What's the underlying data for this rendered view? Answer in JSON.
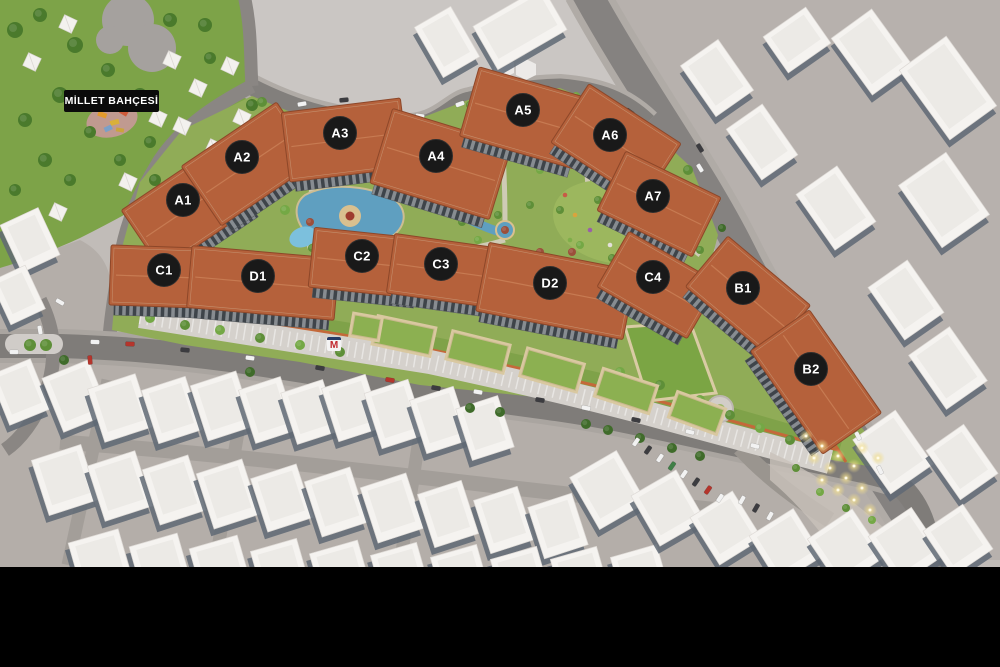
{
  "park": {
    "label": "MİLLET BAHÇESİ"
  },
  "metro": {
    "label": "M"
  },
  "colors": {
    "roof": "#b5613b",
    "roof_edge": "#8d4729",
    "badge": "#191919",
    "badge_text": "#ffffff",
    "grass": "#90ac57",
    "park_green": "#7da348",
    "pond": "#5f9fc0",
    "road": "#817e7b",
    "ground_light": "#cac6c3",
    "ground_pink": "#b7b1ad",
    "ground_bottom": "#b4aea9",
    "white_building": "#f5f3f0",
    "shadow_face": "#5f6874",
    "podium_edge": "#c4693a",
    "pavilion_roof": "#8cb051",
    "letterbox": "#000000"
  },
  "buildings": [
    {
      "label": "A1",
      "x": 183,
      "y": 200,
      "bx": 189,
      "by": 208,
      "w": 115,
      "h": 72,
      "rot": -34
    },
    {
      "label": "A2",
      "x": 242,
      "y": 157,
      "bx": 249,
      "by": 164,
      "w": 115,
      "h": 72,
      "rot": -34
    },
    {
      "label": "A3",
      "x": 340,
      "y": 133,
      "bx": 345,
      "by": 140,
      "w": 120,
      "h": 70,
      "rot": -7
    },
    {
      "label": "A4",
      "x": 436,
      "y": 156,
      "bx": 441,
      "by": 164,
      "w": 125,
      "h": 78,
      "rot": 17
    },
    {
      "label": "A5",
      "x": 523,
      "y": 110,
      "bx": 527,
      "by": 118,
      "w": 120,
      "h": 72,
      "rot": 16
    },
    {
      "label": "A6",
      "x": 610,
      "y": 135,
      "bx": 616,
      "by": 143,
      "w": 110,
      "h": 70,
      "rot": 33
    },
    {
      "label": "A7",
      "x": 653,
      "y": 196,
      "bx": 659,
      "by": 204,
      "w": 106,
      "h": 66,
      "rot": 26
    },
    {
      "label": "C1",
      "x": 164,
      "y": 270,
      "bx": 169,
      "by": 277,
      "w": 118,
      "h": 60,
      "rot": 2
    },
    {
      "label": "D1",
      "x": 258,
      "y": 276,
      "bx": 263,
      "by": 283,
      "w": 148,
      "h": 62,
      "rot": 5
    },
    {
      "label": "C2",
      "x": 362,
      "y": 256,
      "bx": 367,
      "by": 263,
      "w": 112,
      "h": 60,
      "rot": 6
    },
    {
      "label": "C3",
      "x": 441,
      "y": 264,
      "bx": 446,
      "by": 271,
      "w": 112,
      "h": 60,
      "rot": 8
    },
    {
      "label": "D2",
      "x": 550,
      "y": 283,
      "bx": 556,
      "by": 291,
      "w": 150,
      "h": 70,
      "rot": 11
    },
    {
      "label": "C4",
      "x": 653,
      "y": 277,
      "bx": 658,
      "by": 285,
      "w": 104,
      "h": 64,
      "rot": 30
    },
    {
      "label": "B1",
      "x": 743,
      "y": 288,
      "bx": 748,
      "by": 296,
      "w": 108,
      "h": 66,
      "rot": 40
    },
    {
      "label": "B2",
      "x": 811,
      "y": 369,
      "bx": 816,
      "by": 382,
      "w": 126,
      "h": 72,
      "rot": 55
    }
  ],
  "scene": {
    "white_buildings": [
      [
        717,
        78,
        46,
        62,
        -35
      ],
      [
        797,
        40,
        52,
        44,
        -35
      ],
      [
        872,
        52,
        50,
        70,
        -36
      ],
      [
        948,
        88,
        58,
        86,
        -36
      ],
      [
        762,
        142,
        44,
        62,
        -35
      ],
      [
        836,
        208,
        50,
        68,
        -35
      ],
      [
        944,
        200,
        58,
        76,
        -35
      ],
      [
        906,
        300,
        48,
        64,
        -35
      ],
      [
        948,
        368,
        50,
        66,
        -35
      ],
      [
        893,
        452,
        52,
        66,
        -35
      ],
      [
        962,
        462,
        46,
        60,
        -35
      ],
      [
        447,
        42,
        42,
        58,
        -30
      ],
      [
        520,
        28,
        80,
        50,
        -30
      ],
      [
        30,
        240,
        42,
        52,
        -25
      ],
      [
        18,
        295,
        38,
        48,
        -25
      ],
      [
        20,
        392,
        44,
        54,
        -22
      ],
      [
        76,
        396,
        50,
        58,
        -22
      ],
      [
        120,
        408,
        50,
        56,
        -18
      ],
      [
        172,
        410,
        46,
        56,
        -18
      ],
      [
        222,
        406,
        48,
        58,
        -18
      ],
      [
        268,
        410,
        44,
        56,
        -18
      ],
      [
        310,
        412,
        44,
        54,
        -18
      ],
      [
        352,
        408,
        46,
        56,
        -18
      ],
      [
        395,
        414,
        46,
        58,
        -18
      ],
      [
        440,
        420,
        46,
        56,
        -18
      ],
      [
        485,
        428,
        44,
        54,
        -18
      ],
      [
        65,
        480,
        52,
        58,
        -18
      ],
      [
        120,
        486,
        50,
        58,
        -18
      ],
      [
        174,
        490,
        48,
        58,
        -18
      ],
      [
        228,
        494,
        48,
        58,
        -18
      ],
      [
        282,
        498,
        48,
        56,
        -18
      ],
      [
        336,
        502,
        48,
        58,
        -18
      ],
      [
        392,
        508,
        48,
        58,
        -18
      ],
      [
        448,
        514,
        46,
        56,
        -18
      ],
      [
        504,
        520,
        46,
        56,
        -18
      ],
      [
        558,
        526,
        46,
        54,
        -18
      ],
      [
        100,
        560,
        52,
        50,
        -16
      ],
      [
        160,
        564,
        50,
        50,
        -16
      ],
      [
        220,
        566,
        50,
        50,
        -16
      ],
      [
        280,
        568,
        48,
        48,
        -16
      ],
      [
        340,
        570,
        50,
        48,
        -16
      ],
      [
        400,
        572,
        48,
        48,
        -16
      ],
      [
        460,
        574,
        48,
        48,
        -16
      ],
      [
        520,
        576,
        48,
        48,
        -16
      ],
      [
        580,
        576,
        48,
        48,
        -16
      ],
      [
        640,
        574,
        48,
        48,
        -16
      ],
      [
        608,
        490,
        54,
        60,
        -30
      ],
      [
        668,
        508,
        52,
        58,
        -30
      ],
      [
        726,
        528,
        50,
        56,
        -32
      ],
      [
        786,
        546,
        52,
        56,
        -32
      ],
      [
        846,
        548,
        54,
        58,
        -34
      ],
      [
        906,
        546,
        52,
        58,
        -34
      ],
      [
        958,
        540,
        48,
        54,
        -34
      ]
    ],
    "tents": [
      [
        32,
        62
      ],
      [
        68,
        24
      ],
      [
        172,
        60
      ],
      [
        198,
        88
      ],
      [
        182,
        126
      ],
      [
        214,
        148
      ],
      [
        242,
        118
      ],
      [
        128,
        182
      ],
      [
        58,
        212
      ],
      [
        230,
        66
      ],
      [
        158,
        118
      ]
    ],
    "trees": [
      [
        15,
        30,
        8,
        0
      ],
      [
        40,
        15,
        7,
        0
      ],
      [
        75,
        45,
        8,
        0
      ],
      [
        108,
        70,
        7,
        0
      ],
      [
        140,
        95,
        7,
        0
      ],
      [
        60,
        95,
        8,
        0
      ],
      [
        25,
        120,
        7,
        0
      ],
      [
        90,
        132,
        6,
        0
      ],
      [
        150,
        142,
        6,
        0
      ],
      [
        190,
        175,
        7,
        0
      ],
      [
        155,
        180,
        6,
        0
      ],
      [
        120,
        160,
        6,
        0
      ],
      [
        210,
        58,
        6,
        0
      ],
      [
        205,
        25,
        7,
        0
      ],
      [
        170,
        20,
        7,
        0
      ],
      [
        45,
        160,
        7,
        0
      ],
      [
        15,
        190,
        6,
        0
      ],
      [
        70,
        180,
        6,
        0
      ],
      [
        232,
        140,
        6,
        0
      ],
      [
        252,
        105,
        6,
        0
      ],
      [
        262,
        102,
        5,
        1
      ],
      [
        292,
        118,
        5,
        2
      ],
      [
        318,
        112,
        4,
        1
      ],
      [
        410,
        128,
        4,
        2
      ],
      [
        470,
        105,
        4,
        1
      ],
      [
        490,
        112,
        4,
        2
      ],
      [
        548,
        92,
        4,
        1
      ],
      [
        576,
        96,
        4,
        2
      ],
      [
        642,
        128,
        5,
        1
      ],
      [
        668,
        148,
        5,
        2
      ],
      [
        688,
        170,
        5,
        1
      ],
      [
        300,
        180,
        5,
        2
      ],
      [
        320,
        160,
        4,
        1
      ],
      [
        285,
        210,
        5,
        2
      ],
      [
        312,
        248,
        4,
        1
      ],
      [
        335,
        252,
        4,
        2
      ],
      [
        388,
        250,
        4,
        1
      ],
      [
        408,
        245,
        4,
        2
      ],
      [
        420,
        170,
        4,
        1
      ],
      [
        445,
        205,
        4,
        2
      ],
      [
        462,
        222,
        4,
        1
      ],
      [
        478,
        240,
        4,
        2
      ],
      [
        498,
        215,
        4,
        1
      ],
      [
        512,
        250,
        4,
        2
      ],
      [
        530,
        205,
        4,
        1
      ],
      [
        540,
        170,
        4,
        2
      ],
      [
        560,
        210,
        4,
        1
      ],
      [
        580,
        245,
        4,
        2
      ],
      [
        598,
        200,
        4,
        1
      ],
      [
        612,
        258,
        4,
        1
      ],
      [
        630,
        230,
        4,
        2
      ],
      [
        648,
        210,
        4,
        1
      ],
      [
        660,
        250,
        4,
        2
      ],
      [
        676,
        232,
        4,
        1
      ],
      [
        690,
        210,
        4,
        2
      ],
      [
        700,
        250,
        4,
        1
      ],
      [
        588,
        165,
        4,
        2
      ],
      [
        610,
        180,
        4,
        1
      ],
      [
        350,
        168,
        4,
        3
      ],
      [
        370,
        252,
        4,
        3
      ],
      [
        430,
        248,
        4,
        3
      ],
      [
        505,
        230,
        4,
        3
      ],
      [
        572,
        252,
        4,
        3
      ],
      [
        620,
        205,
        4,
        3
      ],
      [
        540,
        252,
        4,
        3
      ],
      [
        310,
        222,
        4,
        3
      ],
      [
        655,
        265,
        4,
        3
      ],
      [
        150,
        318,
        5,
        2
      ],
      [
        185,
        325,
        5,
        1
      ],
      [
        220,
        330,
        5,
        2
      ],
      [
        260,
        338,
        5,
        1
      ],
      [
        300,
        345,
        5,
        2
      ],
      [
        340,
        352,
        5,
        1
      ],
      [
        620,
        372,
        5,
        2
      ],
      [
        660,
        385,
        5,
        1
      ],
      [
        700,
        400,
        5,
        2
      ],
      [
        730,
        415,
        5,
        1
      ],
      [
        760,
        428,
        5,
        2
      ],
      [
        790,
        440,
        5,
        1
      ],
      [
        64,
        360,
        5,
        4
      ],
      [
        250,
        372,
        5,
        4
      ],
      [
        470,
        408,
        5,
        4
      ],
      [
        500,
        412,
        5,
        4
      ],
      [
        608,
        430,
        5,
        4
      ],
      [
        640,
        438,
        5,
        4
      ],
      [
        672,
        448,
        5,
        4
      ],
      [
        700,
        456,
        5,
        4
      ],
      [
        586,
        424,
        5,
        4
      ],
      [
        30,
        345,
        6,
        1
      ],
      [
        46,
        345,
        6,
        1
      ],
      [
        706,
        196,
        4,
        4
      ],
      [
        722,
        228,
        4,
        4
      ],
      [
        738,
        260,
        4,
        4
      ],
      [
        772,
        324,
        4,
        4
      ],
      [
        808,
        388,
        4,
        4
      ],
      [
        826,
        420,
        4,
        4
      ],
      [
        796,
        468,
        4,
        1
      ],
      [
        820,
        492,
        4,
        2
      ],
      [
        846,
        508,
        4,
        1
      ],
      [
        872,
        520,
        4,
        2
      ]
    ],
    "pavilions": [
      [
        404,
        336,
        56,
        26,
        12
      ],
      [
        478,
        352,
        56,
        26,
        14
      ],
      [
        552,
        370,
        56,
        26,
        16
      ],
      [
        626,
        391,
        54,
        26,
        18
      ],
      [
        697,
        413,
        48,
        24,
        20
      ],
      [
        366,
        327,
        26,
        20,
        10
      ]
    ],
    "cars": [
      [
        302,
        104,
        -10,
        0
      ],
      [
        344,
        100,
        -6,
        1
      ],
      [
        420,
        116,
        8,
        0
      ],
      [
        460,
        104,
        -20,
        0
      ],
      [
        545,
        88,
        5,
        2
      ],
      [
        602,
        96,
        20,
        0
      ],
      [
        630,
        112,
        35,
        1
      ],
      [
        700,
        168,
        58,
        0
      ],
      [
        716,
        200,
        58,
        0
      ],
      [
        700,
        148,
        58,
        1
      ],
      [
        744,
        258,
        60,
        0
      ],
      [
        762,
        292,
        60,
        0
      ],
      [
        788,
        330,
        60,
        2
      ],
      [
        806,
        356,
        60,
        0
      ],
      [
        836,
        402,
        62,
        1
      ],
      [
        858,
        436,
        62,
        0
      ],
      [
        880,
        470,
        64,
        0
      ],
      [
        95,
        342,
        2,
        0
      ],
      [
        130,
        344,
        2,
        2
      ],
      [
        185,
        350,
        6,
        1
      ],
      [
        250,
        358,
        8,
        0
      ],
      [
        320,
        368,
        10,
        1
      ],
      [
        390,
        380,
        10,
        2
      ],
      [
        436,
        388,
        10,
        1
      ],
      [
        478,
        392,
        10,
        0
      ],
      [
        540,
        400,
        10,
        1
      ],
      [
        586,
        408,
        12,
        0
      ],
      [
        636,
        420,
        12,
        1
      ],
      [
        690,
        432,
        14,
        0
      ],
      [
        755,
        446,
        14,
        0
      ],
      [
        636,
        442,
        -55,
        0
      ],
      [
        648,
        450,
        -55,
        1
      ],
      [
        660,
        458,
        -55,
        0
      ],
      [
        672,
        466,
        -55,
        3
      ],
      [
        684,
        474,
        -55,
        0
      ],
      [
        696,
        482,
        -55,
        1
      ],
      [
        708,
        490,
        -55,
        2
      ],
      [
        720,
        498,
        -55,
        0
      ],
      [
        742,
        500,
        -60,
        0
      ],
      [
        756,
        508,
        -60,
        1
      ],
      [
        770,
        516,
        -60,
        0
      ],
      [
        90,
        360,
        85,
        2
      ],
      [
        40,
        330,
        80,
        0
      ],
      [
        14,
        352,
        0,
        0
      ],
      [
        60,
        302,
        30,
        0
      ]
    ],
    "car_colors": [
      "#f2f2f2",
      "#3c3c40",
      "#b5352c",
      "#3f7f46"
    ],
    "lights": [
      [
        806,
        436
      ],
      [
        822,
        446
      ],
      [
        838,
        456
      ],
      [
        854,
        466
      ],
      [
        814,
        458
      ],
      [
        830,
        468
      ],
      [
        846,
        478
      ],
      [
        862,
        488
      ],
      [
        822,
        480
      ],
      [
        838,
        490
      ],
      [
        854,
        500
      ],
      [
        870,
        510
      ],
      [
        862,
        448
      ],
      [
        878,
        458
      ]
    ],
    "flowers": [
      [
        565,
        195,
        0
      ],
      [
        575,
        215,
        1
      ],
      [
        590,
        230,
        2
      ],
      [
        610,
        245,
        3
      ],
      [
        625,
        215,
        4
      ],
      [
        640,
        235,
        0
      ],
      [
        655,
        225,
        1
      ],
      [
        600,
        210,
        2
      ],
      [
        570,
        240,
        4
      ],
      [
        615,
        190,
        3
      ]
    ],
    "flower_colors": [
      "#c75b46",
      "#d8a43e",
      "#9a5fa8",
      "#e4e0da",
      "#7fae4a"
    ]
  }
}
